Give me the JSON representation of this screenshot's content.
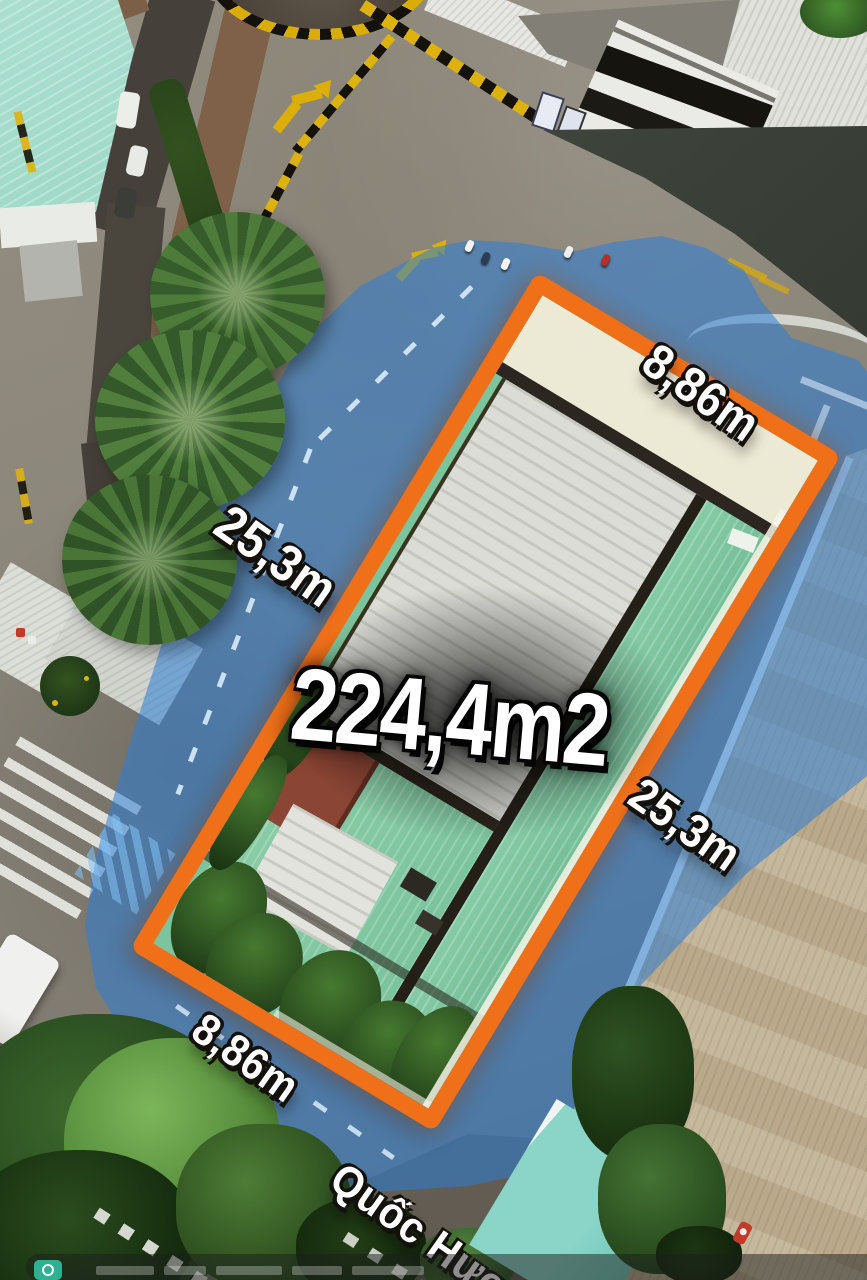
{
  "scene": {
    "street_name": "Quốc Hương",
    "parcel": {
      "area": "224,4m2",
      "frontage_top": "8,86m",
      "side_left": "25,3m",
      "side_right": "25,3m",
      "frontage_bottom": "8,86m",
      "boundary_color": "#F0701A",
      "road_overlay_color": "#2B7ED6",
      "roof_teal_color": "#7CC49E",
      "roof_white_color": "#D7D8D2",
      "roof_red_color": "#8A4433"
    },
    "footer": {
      "icon": "camera-icon"
    }
  }
}
